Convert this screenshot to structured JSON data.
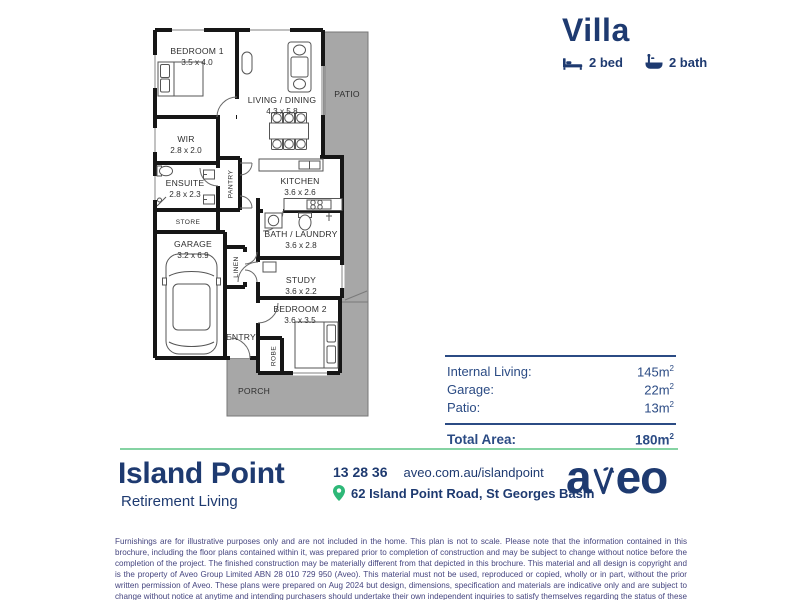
{
  "header": {
    "title": "Villa",
    "bed_label": "2 bed",
    "bath_label": "2 bath"
  },
  "plan": {
    "rooms": {
      "bedroom1": {
        "name": "BEDROOM 1",
        "dims": "3.5 x 4.0"
      },
      "living": {
        "name": "LIVING / DINING",
        "dims": "4.3 x 5.8"
      },
      "patio": {
        "name": "PATIO"
      },
      "wir": {
        "name": "WIR",
        "dims": "2.8 x 2.0"
      },
      "ensuite": {
        "name": "ENSUITE",
        "dims": "2.8 x 2.3"
      },
      "pantry": {
        "name": "PANTRY"
      },
      "store": {
        "name": "STORE"
      },
      "kitchen": {
        "name": "KITCHEN",
        "dims": "3.6 x 2.6"
      },
      "garage": {
        "name": "GARAGE",
        "dims": "3.2 x 6.9"
      },
      "linen": {
        "name": "LINEN"
      },
      "bath_laundry": {
        "name": "BATH / LAUNDRY",
        "dims": "3.6 x 2.8"
      },
      "study": {
        "name": "STUDY",
        "dims": "3.6 x 2.2"
      },
      "bedroom2": {
        "name": "BEDROOM 2",
        "dims": "3.6 x 3.5"
      },
      "entry": {
        "name": "ENTRY"
      },
      "robe": {
        "name": "ROBE"
      },
      "porch": {
        "name": "PORCH"
      }
    }
  },
  "areas": {
    "rows": [
      {
        "label": "Internal Living:",
        "value": "145m",
        "sup": "2"
      },
      {
        "label": "Garage:",
        "value": "22m",
        "sup": "2"
      },
      {
        "label": "Patio:",
        "value": "13m",
        "sup": "2"
      }
    ],
    "total": {
      "label": "Total Area:",
      "value": "180m",
      "sup": "2"
    }
  },
  "footer": {
    "brand": {
      "name": "Island Point",
      "tagline": "Retirement Living"
    },
    "contact": {
      "phone": "13 28 36",
      "website": "aveo.com.au/islandpoint",
      "address": "62 Island Point Road, St Georges Basin"
    },
    "logo": {
      "text": "aveo",
      "part_a": "a",
      "part_eo": "eo"
    }
  },
  "disclaimer": "Furnishings are for illustrative purposes only and are not included in the home. This plan is not to scale. Please note that the information contained in this brochure, including the floor plans contained within it, was prepared prior to completion of construction and may be subject to change without notice before the completion of the project. The finished construction may be materially different from that depicted in this brochure. This material and all design is copyright and is the property of Aveo Group Limited ABN 28 010 729 950 (Aveo). This material must not be used, reproduced or copied, wholly or in part, without the prior written permission of Aveo. These plans were prepared on Aug 2024 but design, dimensions, specification and materials are indicative only and are subject to change without notice at anytime and intending purchasers should undertake their own independent inquiries to satisfy themselves regarding the status of these plans. You should refer to appropriate Survey Plans for confirmation of individual unit areas.",
  "colors": {
    "navy": "#1e3a70",
    "pin_green": "#2eb878",
    "divider_green": "#85d3a3",
    "plan_gray": "#a7a7a7"
  }
}
